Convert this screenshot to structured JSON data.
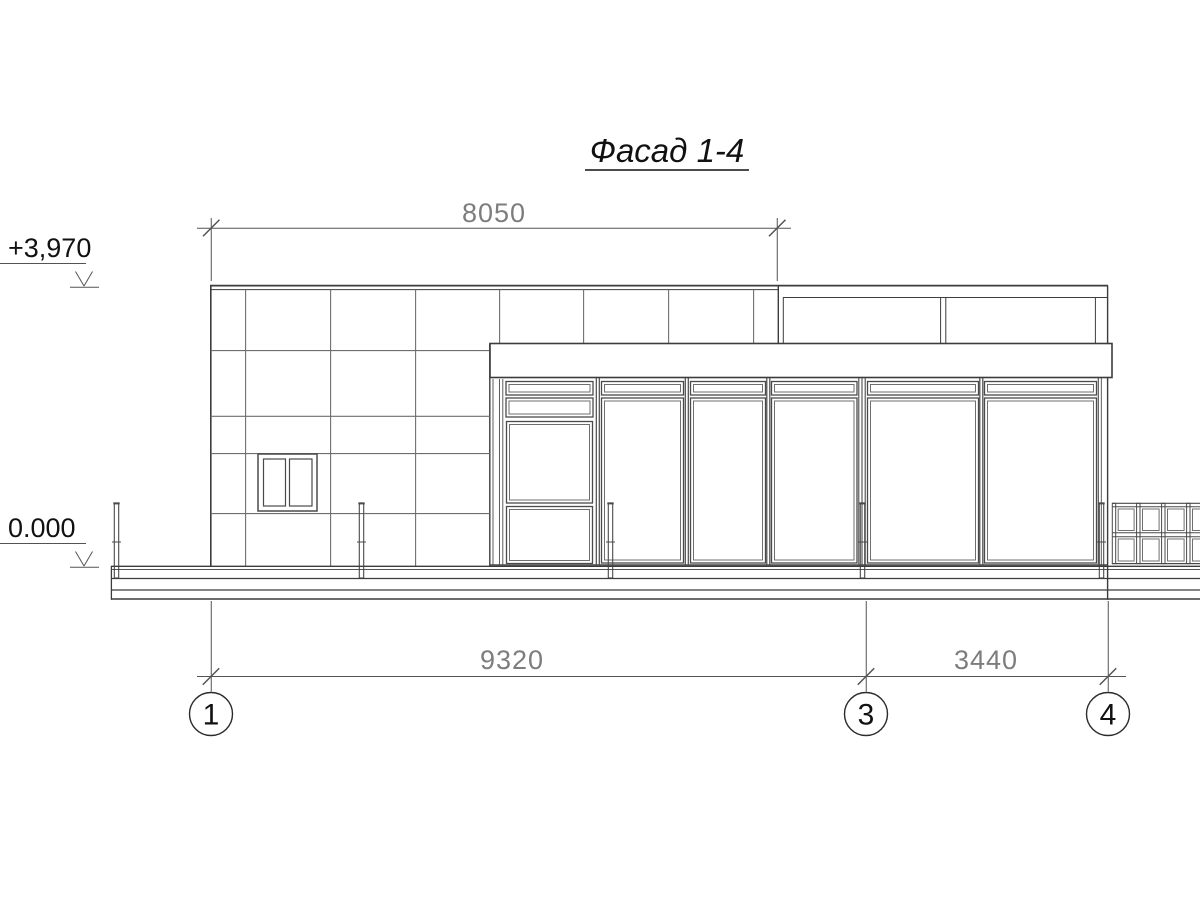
{
  "drawing": {
    "title": "Фасад 1-4",
    "top_dimension": "8050",
    "bottom_dimension_1_3": "9320",
    "bottom_dimension_3_4": "3440",
    "level_top": "+3,970",
    "level_ground": "0.000",
    "axis_1": "1",
    "axis_3": "3",
    "axis_4": "4",
    "colors": {
      "paper": "#ffffff",
      "outline": "#3c3c3c",
      "tile_joint": "#6e6e6e",
      "frame": "#4a4a4a",
      "frame_light": "#6f6f6f",
      "dimension_line": "#535353",
      "dimension_text": "#7d7d7d",
      "annotation_text": "#111111"
    }
  }
}
